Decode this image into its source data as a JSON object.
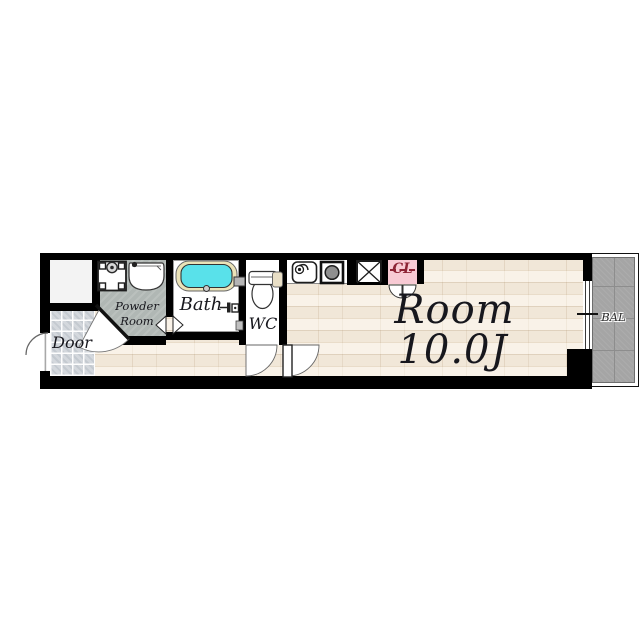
{
  "labels": {
    "entrance": "Door",
    "powder_line1": "Powder",
    "powder_line2": "Room",
    "bath": "Bath",
    "wc": "WC",
    "closet": "CL",
    "room_name": "Room",
    "room_size": "10.0J",
    "balcony": "BAL"
  },
  "colors": {
    "wall": "#000000",
    "wood_floor": "#f2e9dc",
    "powder_floor": "#b0b7b4",
    "entry_tile": "#d4d8dd",
    "balcony_floor": "#a5a5a5",
    "bathtub_fill": "#59e1ea",
    "bathtub_rim": "#ebe3b8",
    "closet_bg": "#f8cad4",
    "closet_text": "#8d2335",
    "label_text": "#17171d"
  },
  "icons": {
    "bathtub": "bathtub-icon",
    "toilet": "toilet-icon",
    "washing_machine_pan": "washing-machine-pan-icon",
    "vanity_sink": "vanity-sink-icon",
    "kitchen_sink": "kitchen-sink-icon",
    "stove": "stove-burner-icon",
    "pipe_shaft": "pipe-shaft-x-icon",
    "window": "sliding-window-icon",
    "doors": "door-swing-arc-icon"
  }
}
